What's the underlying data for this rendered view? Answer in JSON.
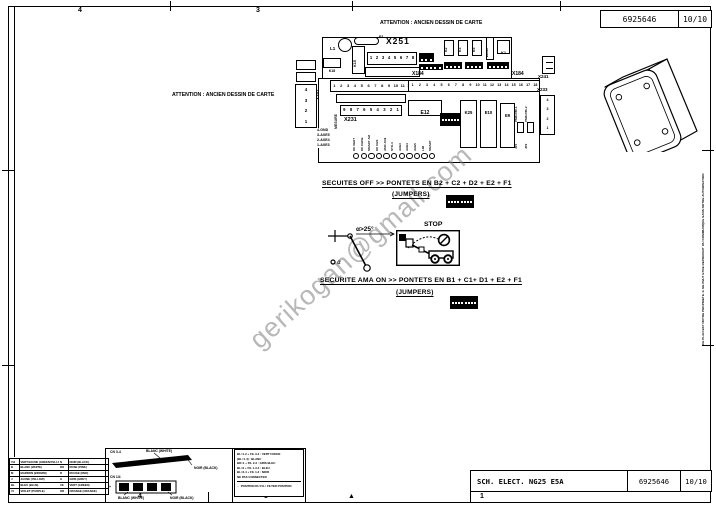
{
  "doc": {
    "number": "6925646",
    "page": "10/10",
    "title": "SCH. ELECT. NG25 E5A"
  },
  "attention": {
    "top": "ATTENTION : ANCIEN DESSIN DE CARTE",
    "left": "ATTENTION : ANCIEN DESSIN DE CARTE"
  },
  "watermark": "gerikogan@gmail.com",
  "ownership_note": {
    "line1": "CE PLAN EST NOTRE PROPRIETE. IL NE PEUT ETRE REPRODUIT",
    "line2": "OU COMMUNIQUE SANS NOTRE AUTORISATION"
  },
  "zones": {
    "top": [
      {
        "label": "4",
        "x": 78
      },
      {
        "label": "3",
        "x": 256
      }
    ],
    "bottom": [
      {
        "label": "4",
        "x": 138
      },
      {
        "label": "3",
        "x": 264
      },
      {
        "label": "▲",
        "x": 348
      },
      {
        "label": "1",
        "x": 480
      }
    ]
  },
  "board": {
    "l1": "L1",
    "f1": "F1",
    "k15": "K15",
    "k18": "K18",
    "k1": "K1",
    "e1819": "E18/19",
    "e12": "E12",
    "k25": "K25",
    "e10": "E10",
    "e9": "E9",
    "relays": [
      "K2",
      "K3",
      "K5"
    ],
    "x251": {
      "label": "X251",
      "pins": [
        "1",
        "2",
        "3",
        "4",
        "5",
        "6",
        "7",
        "8"
      ]
    },
    "x184": {
      "label_left": "X184",
      "label_right": "X184",
      "pins": [
        "1",
        "2",
        "3",
        "4",
        "5",
        "6",
        "7",
        "8",
        "9",
        "10",
        "11",
        "12",
        "13",
        "14",
        "15",
        "16",
        "17",
        "18"
      ]
    },
    "x252": {
      "label": "X252",
      "pins": [
        "1",
        "2",
        "3",
        "4",
        "5",
        "6",
        "7",
        "8",
        "9",
        "10",
        "11",
        "12"
      ]
    },
    "x231": {
      "label": "X231",
      "pins": [
        "9",
        "8",
        "7",
        "6",
        "5",
        "4",
        "3",
        "2",
        "1"
      ]
    },
    "x233": {
      "label": "X233",
      "pins": [
        "4",
        "3",
        "2",
        "1"
      ]
    },
    "x241": {
      "label": "X241"
    },
    "left_connector_pins": [
      "4",
      "3",
      "2",
      "1"
    ],
    "left_pin_list": [
      "4-GND",
      "3-AXE5",
      "2-AXE4",
      "1-AXE3"
    ],
    "mesure": "MESURE",
    "pm1": "PM81786-1",
    "pm2": "PM81786-2",
    "jp1": "JP1",
    "jp2": "JP2",
    "led_labels": [
      "DC VERT",
      "DC CEDE",
      "SMART AM",
      "DK CES",
      "AMC-K19",
      "STD-4",
      "AXE3",
      "AXE4",
      "AXE5",
      "LIM",
      "SMART"
    ]
  },
  "security_off": {
    "line": "SECUITES OFF >> PONTETS EN B2 + C2 + D2 + E2 + F1",
    "jumpers": "(JUMPERS)"
  },
  "security_on": {
    "line": "SECURITE AMA ON >> PONTETS EN B1 + C1+ D1 + E2 + F1",
    "jumpers": "(JUMPERS)"
  },
  "stop_label": "STOP",
  "lever": {
    "angle": "α>25°",
    "plus": "+",
    "alpha": "α"
  },
  "legend_table": {
    "rows": [
      [
        "V/J",
        "VERT/JAUNE (GREEN/YELLOW)",
        "N",
        "NOIR (BLACK)"
      ],
      [
        "B",
        "BLANC (WHITE)",
        "RO",
        "ROSE (PINK)"
      ],
      [
        "M",
        "MARRON (BROWN)",
        "R",
        "ROUGE (RED)"
      ],
      [
        "J",
        "JAUNE (YELLOW)",
        "G",
        "GRIS (GREY)"
      ],
      [
        "BL",
        "BLEU (BLUE)",
        "VE",
        "VERT (GREEN)"
      ],
      [
        "VI",
        "VIOLET (PURPLE)",
        "OR",
        "ORANGE (ORANGE)"
      ]
    ]
  },
  "wiring": {
    "cn1": "CN 3-4",
    "cn2": "CN 1/4",
    "white1": "BLANC (WHITE)",
    "black1": "NOIR (BLACK)",
    "white2": "BLANC (WHITE)",
    "black2": "NOIR (BLACK)",
    "plus": "+"
  },
  "notes": {
    "lines": [
      "BL=1-2 + FIL 3-4 : VERT FONCE",
      "(BL=1-4) : BLANC",
      "BD=1 + FIL 2-3 : GRIS BLEU",
      "BL=2 + FIL 1-3-4 : BLEU",
      "BL=3-4 + FIL 1-2 : NOIR",
      "NE PAS CONNECTER"
    ],
    "arrow_line": "← POSITION DU FIL / FILTER POSITION"
  },
  "colors": {
    "line": "#000000",
    "paper": "#ffffff",
    "watermark": "#7d7d7d"
  }
}
